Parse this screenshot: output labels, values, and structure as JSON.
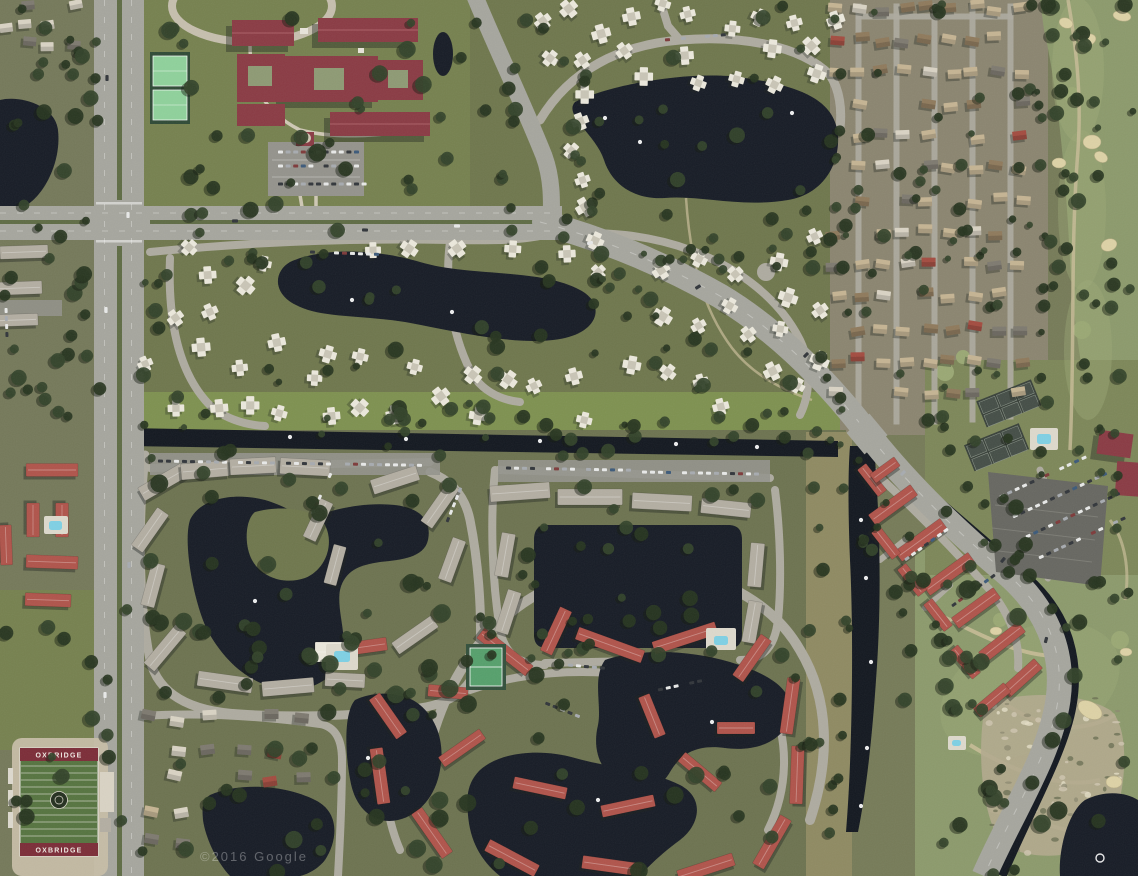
{
  "meta": {
    "width": 1138,
    "height": 876,
    "view": "satellite-aerial"
  },
  "watermark": {
    "text": "©2016 Google"
  },
  "stadium": {
    "end_zone_text": "OXBRIDGE"
  },
  "palette": {
    "base": "#767b58",
    "terrainWest": "#75795a",
    "homesTanZone": "#8b8570",
    "communityGreen": "#6f774d",
    "campusLawn": "#76814f",
    "southCommunity": "#6d7350",
    "brightStrip": "#7e9150",
    "golfGreen": "#8c9a6c",
    "golfFair": "#9dab78",
    "lawnLight": "#9aa874",
    "water": "#171c26",
    "canal": "#131820",
    "roadMajor": "#a6a69e",
    "roadMinor": "#aeaba0",
    "median": "#5f6c45",
    "parking": "#94938c",
    "lotDark": "#676761",
    "whiteRoof": "#ebe8dc",
    "grayRoof": "#b3aea2",
    "redCondoRoof": "#b0544b",
    "maroonRoof": "#8a3b44",
    "tanRoof": "#c5b493",
    "brownRoof": "#8f7a5c",
    "lightRoof": "#d9d3c4",
    "grayHomeRoof": "#7e7a70",
    "redSmallRoof": "#a34c40",
    "bunker": "#ddd2a6",
    "courtGreen": "#8fd19b",
    "courtDark": "#454e47",
    "poolBlue": "#7fd0e4",
    "fieldGreen": "#567440",
    "endZone": "#7c2d38",
    "trackTan": "#c6bda6",
    "treeDark": "#273520",
    "treeMid": "#33432a",
    "scrubBase": "#b3aa8e",
    "pathTan": "#c9bd98",
    "shadow": "#1f241d"
  },
  "render": {
    "houseClusters": [
      {
        "type": "grid",
        "name": "right-homes",
        "seed": 11,
        "x": 836,
        "y": 8,
        "cols": 9,
        "rows": 13,
        "cw": 23,
        "ch": 32,
        "w": 14,
        "h": 9,
        "jit": 4,
        "angJit": 10,
        "skip": 0.16,
        "colors": [
          [
            "tanRoof",
            5
          ],
          [
            "brownRoof",
            2
          ],
          [
            "lightRoof",
            2
          ],
          [
            "redSmallRoof",
            1.2
          ],
          [
            "grayHomeRoof",
            1.5
          ]
        ],
        "avoid": [
          [
            1040,
            0,
            98,
            440
          ]
        ]
      },
      {
        "type": "quad",
        "name": "quads-north",
        "seed": 23,
        "x": 528,
        "y": 2,
        "w": 310,
        "h": 205,
        "n": 26,
        "minD": 27,
        "s": 17,
        "avoid": [
          [
            585,
            85,
            260,
            120
          ],
          [
            520,
            60,
            45,
            170
          ]
        ]
      },
      {
        "type": "quad",
        "name": "quads-mid-west",
        "seed": 37,
        "x": 140,
        "y": 240,
        "w": 400,
        "h": 185,
        "n": 30,
        "minD": 26,
        "s": 17,
        "avoid": [
          [
            280,
            252,
            330,
            100
          ]
        ]
      },
      {
        "type": "quad",
        "name": "quads-mid-east",
        "seed": 41,
        "x": 552,
        "y": 235,
        "w": 290,
        "h": 190,
        "n": 24,
        "minD": 26,
        "s": 17,
        "avoid": [
          [
            552,
            295,
            100,
            70
          ]
        ]
      },
      {
        "type": "grid",
        "name": "top-left-corner",
        "seed": 53,
        "x": 4,
        "y": 6,
        "cols": 4,
        "rows": 3,
        "cw": 23,
        "ch": 19,
        "w": 13,
        "h": 9,
        "jit": 3,
        "angJit": 12,
        "skip": 0.18,
        "colors": [
          [
            "lightRoof",
            3
          ],
          [
            "grayHomeRoof",
            2
          ],
          [
            "redSmallRoof",
            1
          ]
        ],
        "avoid": []
      },
      {
        "type": "grid",
        "name": "bottom-left-homes",
        "seed": 67,
        "x": 148,
        "y": 718,
        "cols": 6,
        "rows": 5,
        "cw": 31,
        "ch": 31,
        "w": 14,
        "h": 10,
        "jit": 5,
        "angJit": 14,
        "skip": 0.22,
        "colors": [
          [
            "grayHomeRoof",
            3
          ],
          [
            "lightRoof",
            2
          ],
          [
            "tanRoof",
            1.5
          ],
          [
            "redSmallRoof",
            1
          ]
        ],
        "avoid": [
          [
            200,
            788,
            140,
            90
          ]
        ]
      }
    ],
    "buildings": [
      [
        163,
        482,
        50,
        15,
        -30,
        "grayRoof"
      ],
      [
        205,
        470,
        48,
        16,
        -5,
        "grayRoof"
      ],
      [
        253,
        466,
        46,
        16,
        -3,
        "grayRoof"
      ],
      [
        305,
        467,
        50,
        16,
        3,
        "grayRoof"
      ],
      [
        150,
        530,
        46,
        14,
        -55,
        "grayRoof"
      ],
      [
        153,
        585,
        44,
        14,
        -75,
        "grayRoof"
      ],
      [
        165,
        648,
        50,
        14,
        -50,
        "grayRoof"
      ],
      [
        225,
        682,
        55,
        15,
        8,
        "grayRoof"
      ],
      [
        288,
        687,
        52,
        15,
        -5,
        "grayRoof"
      ],
      [
        345,
        680,
        40,
        14,
        3,
        "grayRoof"
      ],
      [
        395,
        480,
        48,
        15,
        -18,
        "grayRoof"
      ],
      [
        440,
        505,
        48,
        14,
        -55,
        "grayRoof"
      ],
      [
        452,
        560,
        44,
        14,
        -70,
        "grayRoof"
      ],
      [
        415,
        635,
        48,
        14,
        -35,
        "grayRoof"
      ],
      [
        318,
        520,
        42,
        14,
        -65,
        "grayRoof"
      ],
      [
        335,
        565,
        40,
        13,
        -75,
        "grayRoof"
      ],
      [
        520,
        492,
        60,
        16,
        -4,
        "grayRoof"
      ],
      [
        590,
        497,
        65,
        16,
        0,
        "grayRoof"
      ],
      [
        662,
        502,
        60,
        16,
        3,
        "grayRoof"
      ],
      [
        726,
        508,
        50,
        15,
        6,
        "grayRoof"
      ],
      [
        505,
        555,
        44,
        14,
        -80,
        "grayRoof"
      ],
      [
        508,
        612,
        44,
        14,
        -72,
        "grayRoof"
      ],
      [
        756,
        565,
        44,
        14,
        -85,
        "grayRoof"
      ],
      [
        752,
        622,
        42,
        14,
        -80,
        "grayRoof"
      ],
      [
        24,
        252,
        48,
        13,
        -2,
        "grayRoof"
      ],
      [
        20,
        288,
        44,
        13,
        -2,
        "grayRoof"
      ],
      [
        18,
        320,
        40,
        12,
        -2,
        "grayRoof"
      ],
      [
        52,
        470,
        52,
        13,
        0,
        "redCondoRoof"
      ],
      [
        33,
        520,
        34,
        13,
        90,
        "redCondoRoof"
      ],
      [
        62,
        520,
        34,
        13,
        90,
        "redCondoRoof"
      ],
      [
        52,
        562,
        52,
        13,
        2,
        "redCondoRoof"
      ],
      [
        48,
        600,
        46,
        13,
        2,
        "redCondoRoof"
      ],
      [
        6,
        545,
        40,
        12,
        88,
        "redCondoRoof"
      ],
      [
        505,
        652,
        62,
        13,
        38,
        "redCondoRoof"
      ],
      [
        556,
        631,
        48,
        13,
        -65,
        "redCondoRoof"
      ],
      [
        610,
        645,
        70,
        13,
        20,
        "redCondoRoof"
      ],
      [
        685,
        638,
        66,
        13,
        -18,
        "redCondoRoof"
      ],
      [
        752,
        658,
        50,
        13,
        -55,
        "redCondoRoof"
      ],
      [
        790,
        706,
        56,
        13,
        -82,
        "redCondoRoof"
      ],
      [
        797,
        775,
        58,
        13,
        -88,
        "redCondoRoof"
      ],
      [
        772,
        842,
        56,
        13,
        -60,
        "redCondoRoof"
      ],
      [
        706,
        868,
        58,
        13,
        -18,
        "redCondoRoof"
      ],
      [
        612,
        866,
        60,
        13,
        8,
        "redCondoRoof"
      ],
      [
        512,
        858,
        56,
        13,
        28,
        "redCondoRoof"
      ],
      [
        432,
        833,
        54,
        13,
        55,
        "redCondoRoof"
      ],
      [
        380,
        776,
        56,
        13,
        82,
        "redCondoRoof"
      ],
      [
        388,
        716,
        48,
        13,
        55,
        "redCondoRoof"
      ],
      [
        462,
        748,
        50,
        12,
        -35,
        "redCondoRoof"
      ],
      [
        540,
        788,
        54,
        12,
        12,
        "redCondoRoof"
      ],
      [
        628,
        806,
        54,
        12,
        -12,
        "redCondoRoof"
      ],
      [
        700,
        772,
        48,
        12,
        40,
        "redCondoRoof"
      ],
      [
        652,
        716,
        44,
        12,
        68,
        "redCondoRoof"
      ],
      [
        448,
        692,
        40,
        12,
        5,
        "redCondoRoof"
      ],
      [
        736,
        728,
        38,
        12,
        0,
        "redCondoRoof"
      ],
      [
        370,
        646,
        34,
        13,
        -8,
        "redCondoRoof"
      ],
      [
        893,
        505,
        52,
        13,
        -36,
        "redCondoRoof"
      ],
      [
        921,
        540,
        56,
        13,
        -36,
        "redCondoRoof"
      ],
      [
        949,
        574,
        56,
        13,
        -36,
        "redCondoRoof"
      ],
      [
        976,
        608,
        52,
        13,
        -36,
        "redCondoRoof"
      ],
      [
        1002,
        642,
        50,
        13,
        -38,
        "redCondoRoof"
      ],
      [
        1022,
        678,
        44,
        13,
        -42,
        "redCondoRoof"
      ],
      [
        886,
        543,
        34,
        11,
        52,
        "redCondoRoof"
      ],
      [
        912,
        580,
        34,
        11,
        52,
        "redCondoRoof"
      ],
      [
        938,
        615,
        34,
        11,
        52,
        "redCondoRoof"
      ],
      [
        872,
        480,
        34,
        11,
        52,
        "redCondoRoof"
      ],
      [
        885,
        470,
        30,
        11,
        -36,
        "redCondoRoof"
      ],
      [
        965,
        662,
        36,
        11,
        50,
        "redCondoRoof"
      ],
      [
        992,
        700,
        40,
        12,
        -40,
        "redCondoRoof"
      ],
      [
        330,
        652,
        30,
        20,
        0,
        "whiteRoof"
      ]
    ],
    "streets": [
      [
        856,
        4,
        5,
        420
      ],
      [
        894,
        4,
        5,
        420
      ],
      [
        932,
        4,
        5,
        420
      ],
      [
        970,
        4,
        5,
        418
      ],
      [
        1008,
        4,
        5,
        415
      ],
      [
        856,
        14,
        157,
        5
      ]
    ],
    "treeBelts": [
      [
        140,
        0,
        330,
        215,
        30,
        4,
        9
      ],
      [
        470,
        0,
        70,
        220,
        10,
        4,
        8
      ],
      [
        528,
        0,
        320,
        215,
        26,
        4,
        8
      ],
      [
        140,
        230,
        410,
        195,
        40,
        3,
        8
      ],
      [
        552,
        230,
        300,
        195,
        30,
        3,
        8
      ],
      [
        830,
        0,
        215,
        430,
        55,
        3,
        7
      ],
      [
        1038,
        0,
        100,
        455,
        40,
        3,
        8
      ],
      [
        125,
        408,
        720,
        40,
        26,
        3,
        7
      ],
      [
        130,
        445,
        360,
        280,
        40,
        4,
        9
      ],
      [
        480,
        448,
        300,
        215,
        26,
        4,
        8
      ],
      [
        330,
        612,
        490,
        260,
        48,
        4,
        9
      ],
      [
        850,
        438,
        180,
        280,
        34,
        3,
        8
      ],
      [
        940,
        575,
        198,
        300,
        30,
        4,
        9
      ],
      [
        0,
        585,
        340,
        289,
        38,
        4,
        9
      ],
      [
        0,
        225,
        100,
        205,
        22,
        4,
        8
      ],
      [
        0,
        0,
        100,
        225,
        20,
        4,
        8
      ],
      [
        925,
        355,
        215,
        235,
        20,
        3,
        7
      ],
      [
        560,
        190,
        290,
        130,
        16,
        3,
        7
      ],
      [
        806,
        430,
        48,
        440,
        18,
        3,
        7
      ]
    ],
    "carRows": [
      [
        278,
        152,
        0,
        11,
        7.6
      ],
      [
        278,
        166,
        0,
        11,
        7.6
      ],
      [
        278,
        184,
        0,
        12,
        7.6
      ],
      [
        158,
        461,
        1,
        22,
        8
      ],
      [
        345,
        464,
        1,
        10,
        8
      ],
      [
        506,
        468,
        1,
        16,
        8
      ],
      [
        642,
        472,
        1,
        15,
        8
      ],
      [
        1000,
        497,
        -25,
        12,
        8.2
      ],
      [
        1013,
        517,
        -25,
        13,
        8.2
      ],
      [
        1026,
        537,
        -25,
        13,
        8.2
      ],
      [
        1039,
        558,
        -25,
        12,
        8.2
      ],
      [
        312,
        514,
        -65,
        6,
        8
      ],
      [
        447,
        522,
        -68,
        6,
        8
      ],
      [
        538,
        700,
        22,
        6,
        8
      ],
      [
        658,
        690,
        -12,
        6,
        8
      ],
      [
        905,
        560,
        -36,
        7,
        8
      ],
      [
        952,
        606,
        -36,
        7,
        8
      ],
      [
        6,
        308,
        88,
        5,
        8
      ],
      [
        665,
        40,
        -5,
        8,
        8
      ],
      [
        310,
        252,
        2,
        9,
        8
      ],
      [
        568,
        665,
        5,
        5,
        8
      ]
    ],
    "roadCars": [
      [
        107,
        78,
        90
      ],
      [
        106,
        310,
        90
      ],
      [
        128,
        215,
        90
      ],
      [
        129,
        565,
        90
      ],
      [
        105,
        695,
        90
      ],
      [
        126,
        820,
        90
      ],
      [
        235,
        221,
        0
      ],
      [
        365,
        230,
        2
      ],
      [
        457,
        226,
        0
      ],
      [
        590,
        243,
        -18
      ],
      [
        698,
        287,
        -32
      ],
      [
        806,
        355,
        -45
      ],
      [
        903,
        473,
        -45
      ],
      [
        1003,
        560,
        -52
      ],
      [
        1046,
        640,
        -75
      ]
    ],
    "dots": [
      [
        290,
        437
      ],
      [
        406,
        439
      ],
      [
        540,
        441
      ],
      [
        676,
        444
      ],
      [
        757,
        447
      ],
      [
        861,
        520
      ],
      [
        866,
        578
      ],
      [
        871,
        662
      ],
      [
        867,
        748
      ],
      [
        861,
        806
      ],
      [
        605,
        118
      ],
      [
        640,
        142
      ],
      [
        792,
        113
      ],
      [
        352,
        300
      ],
      [
        452,
        312
      ],
      [
        255,
        601
      ],
      [
        712,
        722
      ],
      [
        598,
        800
      ],
      [
        368,
        758
      ]
    ],
    "rings": [
      [
        1100,
        858,
        4
      ]
    ],
    "bunkers": [
      [
        1066,
        23,
        7,
        5,
        20
      ],
      [
        1087,
        40,
        9,
        6,
        -15
      ],
      [
        1092,
        142,
        9,
        7,
        0
      ],
      [
        1101,
        157,
        7,
        5,
        30
      ],
      [
        1059,
        163,
        7,
        5,
        0
      ],
      [
        1109,
        245,
        8,
        6,
        -20
      ],
      [
        1122,
        16,
        9,
        5,
        10
      ],
      [
        1090,
        710,
        13,
        8,
        30
      ],
      [
        1114,
        782,
        8,
        6,
        0
      ],
      [
        1049,
        643,
        7,
        5,
        10
      ],
      [
        996,
        631,
        6,
        4,
        0
      ],
      [
        1126,
        652,
        6,
        4,
        0
      ]
    ],
    "pools": [
      [
        326,
        644,
        32,
        26,
        334,
        651,
        16,
        11
      ],
      [
        1030,
        428,
        28,
        22,
        1037,
        434,
        14,
        10
      ],
      [
        44,
        516,
        24,
        18,
        49,
        521,
        13,
        9
      ],
      [
        948,
        736,
        18,
        14,
        952,
        740,
        9,
        6
      ],
      [
        706,
        628,
        30,
        22,
        714,
        636,
        14,
        9
      ]
    ],
    "scrub": {
      "x": 988,
      "y": 698,
      "w": 135,
      "h": 155,
      "n": 85
    },
    "stadiumLines": {
      "x": 21,
      "w": 76,
      "y0": 766,
      "gap": 7,
      "n": 11
    }
  }
}
